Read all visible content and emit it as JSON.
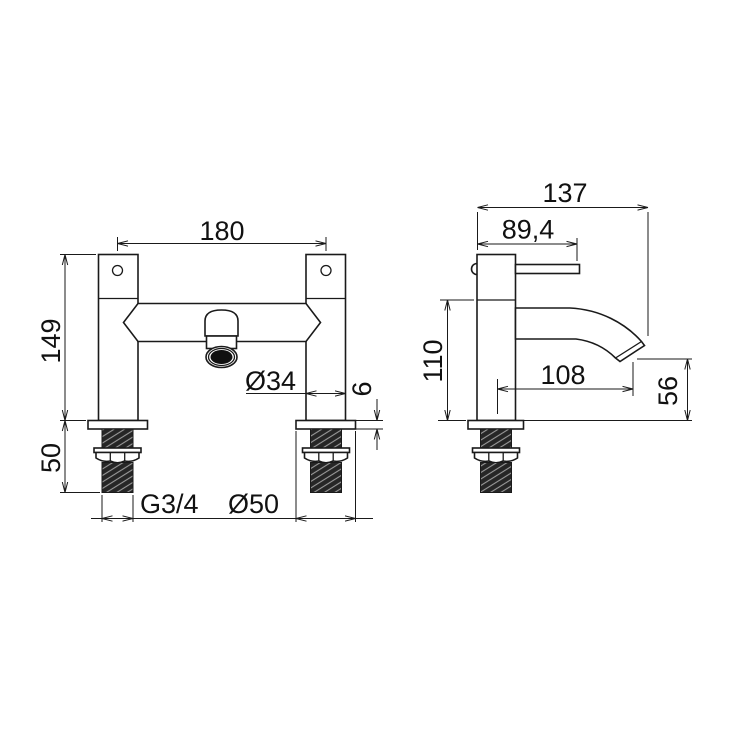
{
  "drawing": {
    "type": "technical-dimension-drawing",
    "subject": "deck mounted bath filler tap",
    "units": "mm",
    "colors": {
      "line": "#1a1a1a",
      "background": "#ffffff",
      "thread_fill": "#262626",
      "outlet_fill": "#111111"
    },
    "views": {
      "front": {
        "name": "front-view",
        "dimensions": {
          "hole_centres": "180",
          "body_height": "149",
          "thread_length": "50",
          "pillar_diameter": "Ø34",
          "base_thickness": "6",
          "thread_size": "G3/4",
          "base_diameter": "Ø50"
        }
      },
      "side": {
        "name": "side-view",
        "dimensions": {
          "overall_depth": "137",
          "handle_reach": "89,4",
          "height_to_spout_underbody": "110",
          "spout_reach": "108",
          "spout_outlet_height": "56"
        }
      }
    }
  }
}
